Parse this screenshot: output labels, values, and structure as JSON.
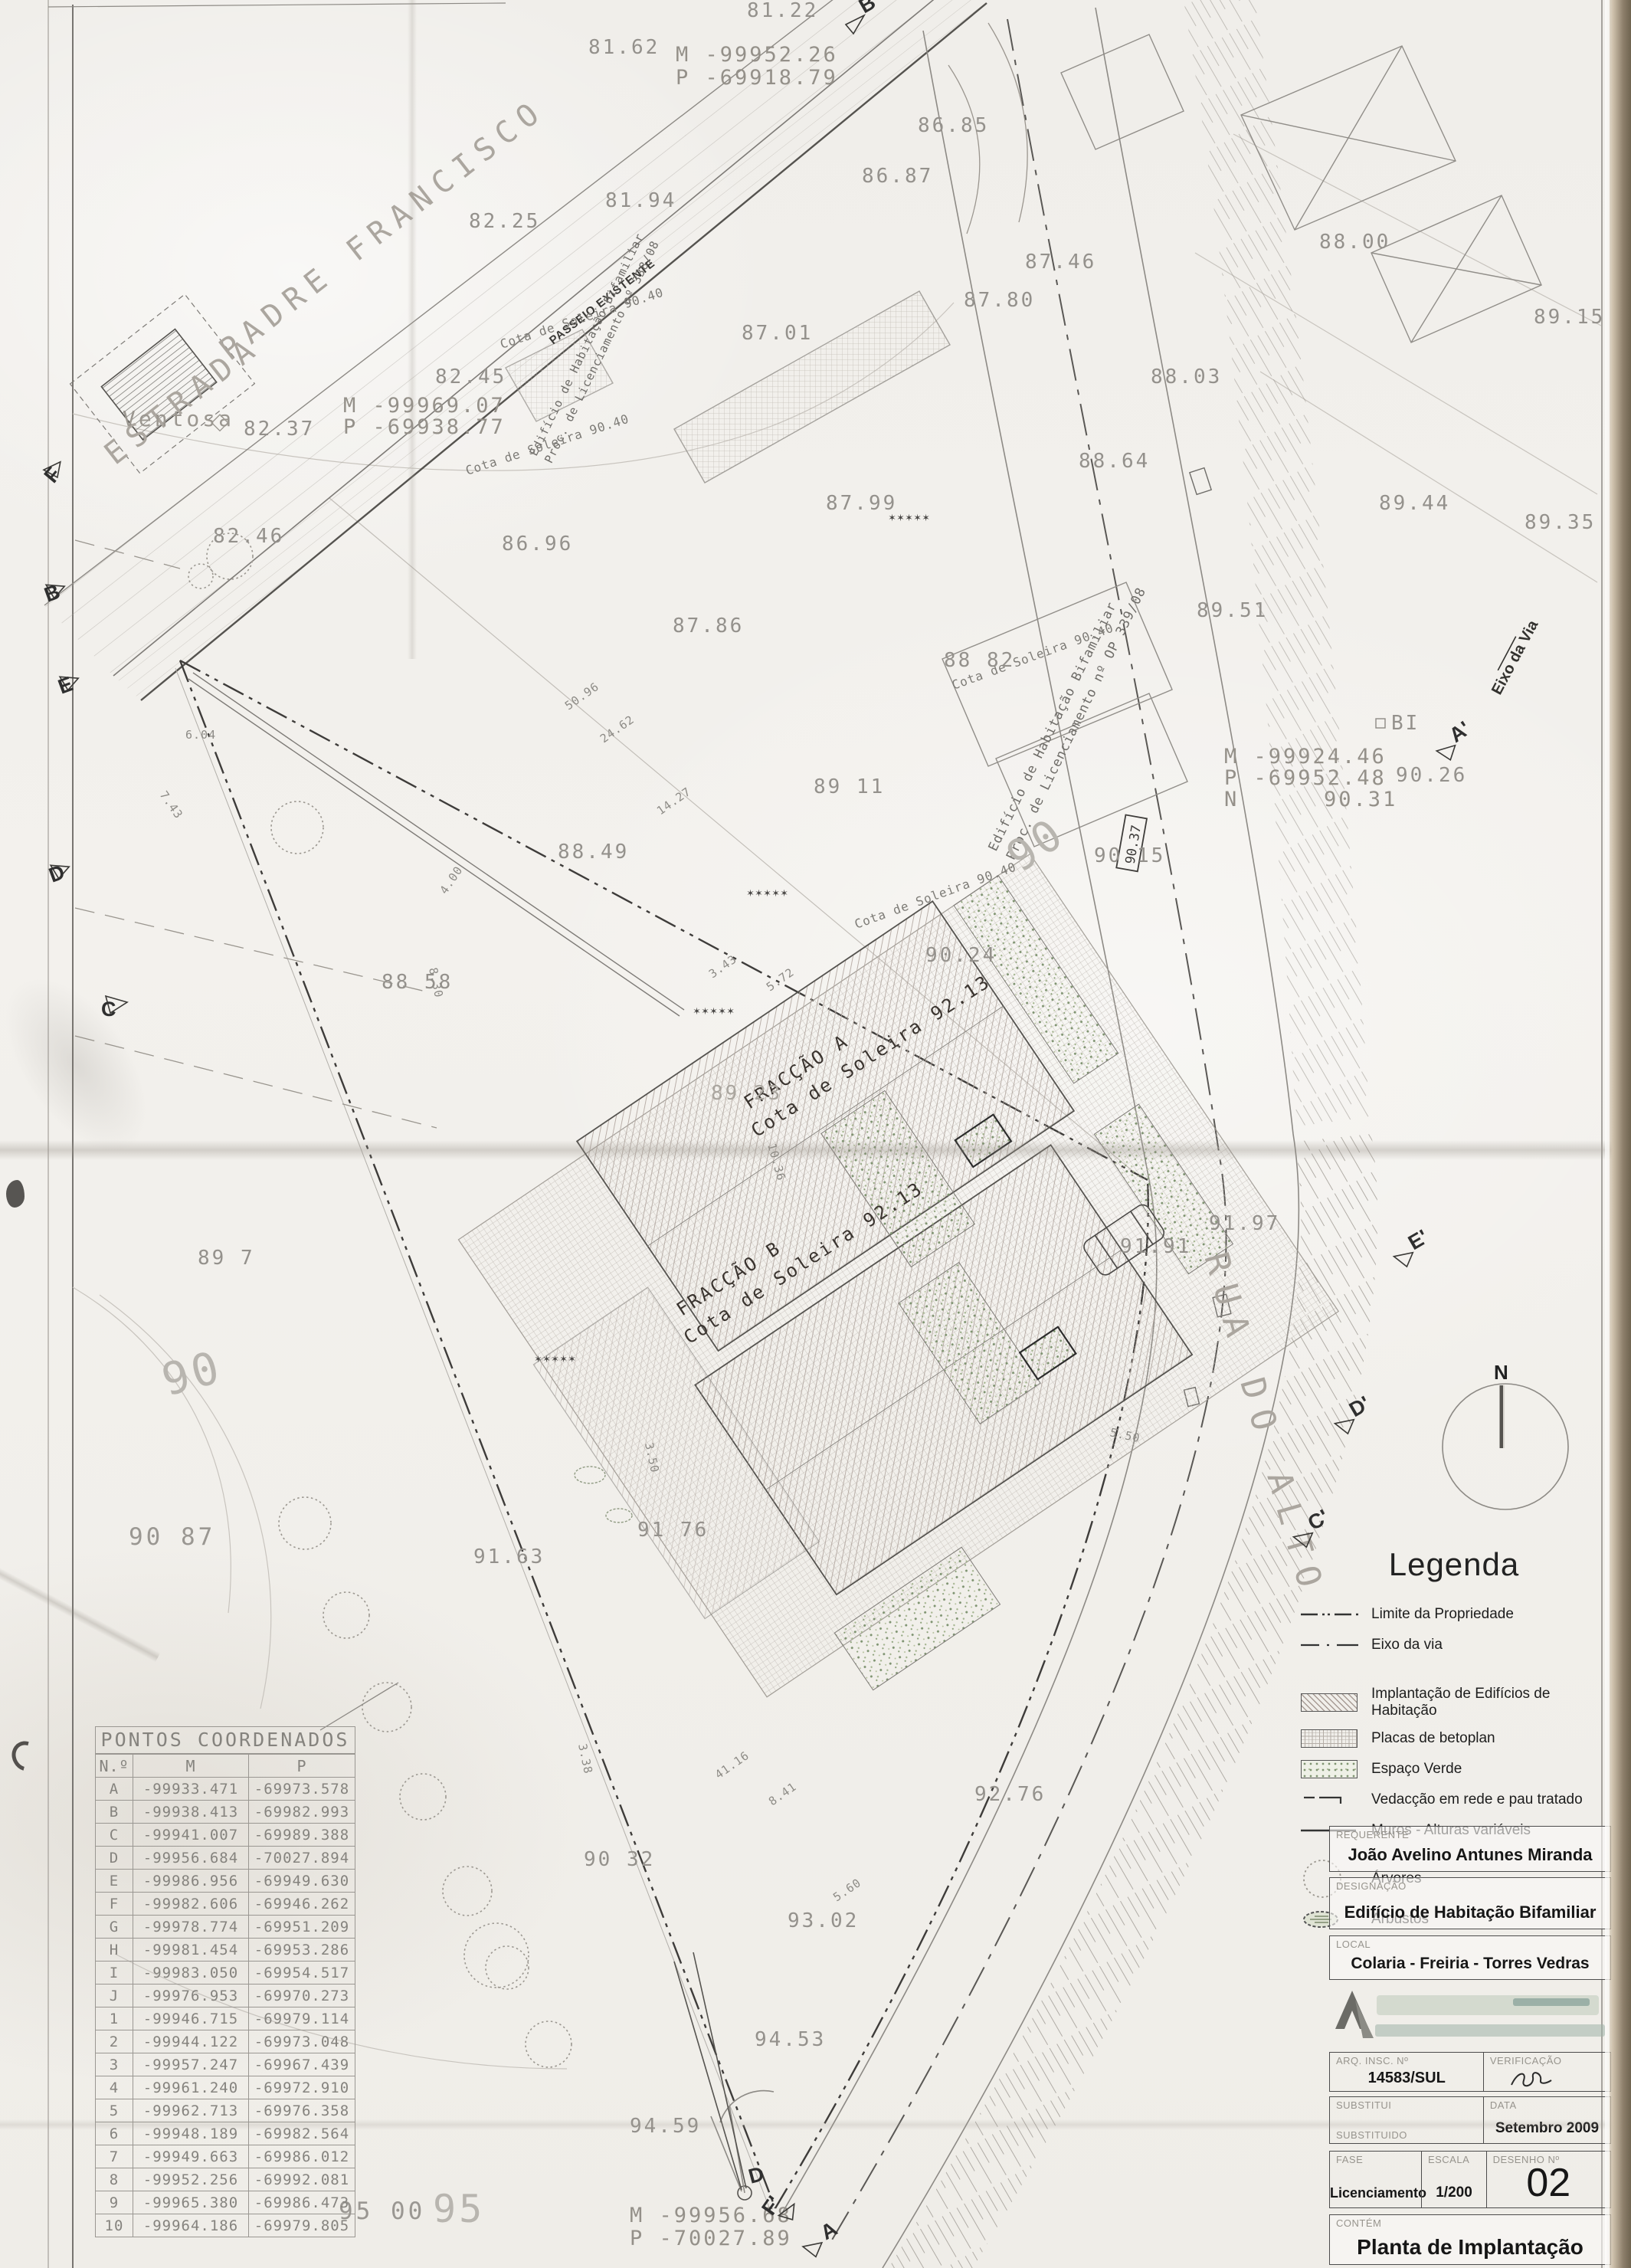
{
  "plan": {
    "streets": {
      "estrada": "ESTRADA",
      "padre_francisco": "PADRE FRANCISCO",
      "passeio": "PASSEIO EXISTENTE",
      "rua_do_alto": "RUA DO ALTO",
      "eixo_da_via": "Eixo da Via",
      "ventosa": "Ventosa"
    },
    "fraccao_a": {
      "line1": "FRACÇÃO A",
      "line2": "Cota de Soleira 92.13"
    },
    "fraccao_b": {
      "line1": "FRACÇÃO B",
      "line2": "Cota de Soleira 92.13"
    },
    "neighbor_note_left": {
      "line1": "Edifício de Habitação Bifamiliar",
      "line2": "Proc. de Licenciamento nº 338/08"
    },
    "neighbor_note_right": {
      "line1": "Edifício de Habitação Bifamiliar",
      "line2": "Proc. de Licenciamento nº OP 339/08"
    },
    "cota_soleira_label": "Cota de Soleira 90.40",
    "coord_notes": {
      "top": {
        "m": "M -99952.26",
        "p": "P -69918.79"
      },
      "west": {
        "m": "M -99969.07",
        "p": "P -69938.77"
      },
      "east": {
        "m": "M -99924.46",
        "p": "P -69952.48",
        "n_label": "N",
        "n_value": "90.31"
      },
      "south": {
        "m": "M -99956.68",
        "p": "P -70027.89"
      }
    },
    "bi_label": "BI",
    "boxed_elevation": "90.37",
    "spots": [
      "81.22",
      "81.62",
      "86.85",
      "86.87",
      "87.01",
      "87.46",
      "87.80",
      "88.00",
      "88.03",
      "82.25",
      "81.94",
      "82.45",
      "82.37",
      "82.46",
      "86.96",
      "87.99",
      "88.64",
      "89.44",
      "89.35",
      "89.15",
      "89.51",
      "88 82",
      "87.86",
      "89 11",
      "88.49",
      "90 15",
      "90.24",
      "88 58",
      "90.26",
      "89 23",
      "89 7",
      "91.97",
      "91.91",
      "90 87",
      "91 76",
      "91.63",
      "92.76",
      "90 32",
      "93.02",
      "94.53",
      "94.59",
      "95 00"
    ],
    "contours": [
      "90",
      "90",
      "95"
    ],
    "dims": [
      "4.00",
      "3.50",
      "5.60",
      "14.27",
      "10.36",
      "24.62",
      "50.96",
      "8.30",
      "3.43",
      "5.72",
      "7.43",
      "6.04",
      "5.50",
      "8.41",
      "41.16",
      "3.38"
    ],
    "markers": {
      "top_b": "B",
      "left_f": "F",
      "left_b": "B",
      "left_e": "E",
      "left_d": "D",
      "left_c": "C",
      "right_a": "A'",
      "right_e": "E'",
      "right_d": "D'",
      "right_c": "C'",
      "bottom_d": "D",
      "bottom_f": "F'",
      "bottom_a": "A"
    }
  },
  "compass": {
    "north": "N"
  },
  "coordinates_table": {
    "title": "PONTOS COORDENADOS",
    "headers": [
      "N.º",
      "M",
      "P"
    ],
    "rows": [
      [
        "A",
        "-99933.471",
        "-69973.578"
      ],
      [
        "B",
        "-99938.413",
        "-69982.993"
      ],
      [
        "C",
        "-99941.007",
        "-69989.388"
      ],
      [
        "D",
        "-99956.684",
        "-70027.894"
      ],
      [
        "E",
        "-99986.956",
        "-69949.630"
      ],
      [
        "F",
        "-99982.606",
        "-69946.262"
      ],
      [
        "G",
        "-99978.774",
        "-69951.209"
      ],
      [
        "H",
        "-99981.454",
        "-69953.286"
      ],
      [
        "I",
        "-99983.050",
        "-69954.517"
      ],
      [
        "J",
        "-99976.953",
        "-69970.273"
      ],
      [
        "1",
        "-99946.715",
        "-69979.114"
      ],
      [
        "2",
        "-99944.122",
        "-69973.048"
      ],
      [
        "3",
        "-99957.247",
        "-69967.439"
      ],
      [
        "4",
        "-99961.240",
        "-69972.910"
      ],
      [
        "5",
        "-99962.713",
        "-69976.358"
      ],
      [
        "6",
        "-99948.189",
        "-69982.564"
      ],
      [
        "7",
        "-99949.663",
        "-69986.012"
      ],
      [
        "8",
        "-99952.256",
        "-69992.081"
      ],
      [
        "9",
        "-99965.380",
        "-69986.473"
      ],
      [
        "10",
        "-99964.186",
        "-69979.805"
      ]
    ]
  },
  "legend": {
    "title": "Legenda",
    "items": [
      {
        "symbol": "property-line-symbol",
        "label": "Limite da Propriedade"
      },
      {
        "symbol": "road-axis-line-symbol",
        "label": "Eixo da via"
      },
      {
        "symbol": "diagonal-hatch-swatch",
        "label": "Implantação de Edifícios de Habitação"
      },
      {
        "symbol": "grid-hatch-swatch",
        "label": "Placas de betoplan"
      },
      {
        "symbol": "green-stipple-swatch",
        "label": "Espaço Verde"
      },
      {
        "symbol": "fence-symbol",
        "label": "Vedacção em rede e pau tratado"
      },
      {
        "symbol": "wall-symbol",
        "label": "Muros - Alturas variáveis"
      },
      {
        "symbol": "tree-symbol",
        "label": "Árvores"
      },
      {
        "symbol": "shrub-symbol",
        "label": "Arbustos"
      }
    ]
  },
  "title_block": {
    "requerente_label": "REQUERENTE",
    "requerente": "João Avelino Antunes Miranda",
    "designacao_label": "DESIGNAÇÃO",
    "designacao": "Edifício de Habitação Bifamiliar",
    "local_label": "LOCAL",
    "local": "Colaria - Freiria - Torres Vedras",
    "arq_label": "ARQ. INSC. Nº",
    "arq": "14583/SUL",
    "verificacao_label": "VERIFICAÇÃO",
    "substitui_label": "SUBSTITUI",
    "substituido_label": "SUBSTITUIDO",
    "data_label": "DATA",
    "data": "Setembro 2009",
    "fase_label": "FASE",
    "fase": "Licenciamento",
    "escala_label": "ESCALA",
    "escala": "1/200",
    "desenho_label": "DESENHO Nº",
    "desenho": "02",
    "contem_label": "CONTÉM",
    "contem": "Planta de Implantação"
  }
}
